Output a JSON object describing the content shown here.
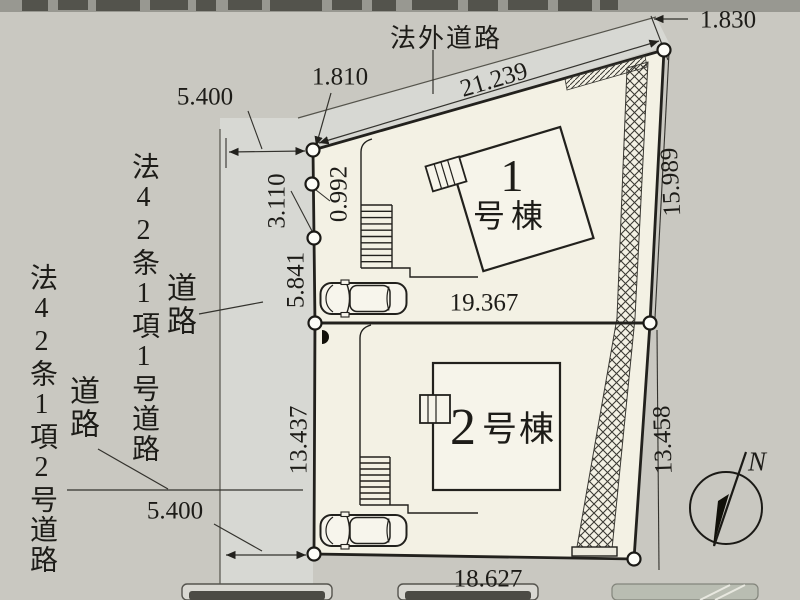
{
  "roads": {
    "top_road_label": "法外道路",
    "left_road_upper_name": "法42条1項1号道路",
    "left_road_upper_tag": "道路",
    "left_road_lower_name": "法42条1項2号道路",
    "left_road_lower_tag": "道路"
  },
  "buildings": {
    "b1_number": "1",
    "b1_suffix": "号棟",
    "b2_number": "2",
    "b2_suffix": "号棟"
  },
  "dimensions": {
    "top_edge": "21.239",
    "top_left": "1.810",
    "top_right": "1.830",
    "right_upper": "15.989",
    "right_lower": "13.458",
    "road_width_top": "5.400",
    "road_width_bottom": "5.400",
    "seg_0992": "0.992",
    "seg_3110": "3.110",
    "seg_5841": "5.841",
    "seg_13437": "13.437",
    "mid_edge": "19.367",
    "bottom_edge": "18.627"
  },
  "compass": {
    "north_label": "N"
  },
  "colors": {
    "background": "#c9c8c1",
    "road": "#d7d8d3",
    "lot": "#f3f1e4",
    "line": "#22211d"
  }
}
